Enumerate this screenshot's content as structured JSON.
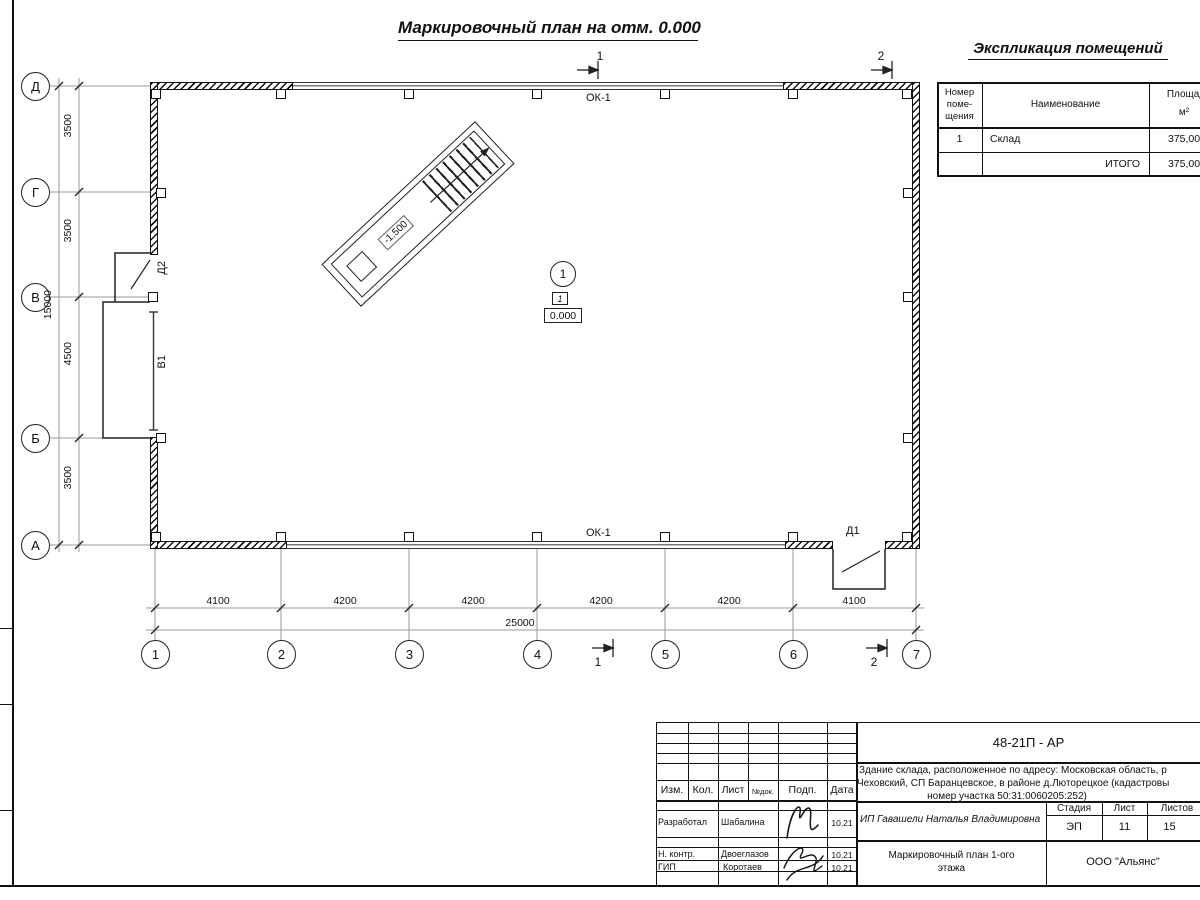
{
  "sheet": {
    "plan_title": "Маркировочный план на отм. 0.000"
  },
  "explication": {
    "title": "Экспликация помещений",
    "col_number_l1": "Номер",
    "col_number_l2": "поме-",
    "col_number_l3": "щения",
    "col_name": "Наименование",
    "col_area_l1": "Площадь,",
    "col_area_l2": "м²",
    "row1_number": "1",
    "row1_name": "Склад",
    "row1_area": "375,00",
    "total_label": "ИТОГО",
    "total_value": "375,00"
  },
  "plan": {
    "ok1_top": "ОК-1",
    "ok1_bottom": "ОК-1",
    "d1": "Д1",
    "d2": "Д2",
    "v1": "В1",
    "ramp_elev": "-1.500",
    "room_circle": "1",
    "room_floor": "1",
    "room_elev": "0.000",
    "sec1_top": "1",
    "sec2_top": "2",
    "sec1_bottom": "1",
    "sec2_bottom": "2",
    "axis_d": "Д",
    "axis_g": "Г",
    "axis_v": "В",
    "axis_b": "Б",
    "axis_a": "А",
    "ax1": "1",
    "ax2": "2",
    "ax3": "3",
    "ax4": "4",
    "ax5": "5",
    "ax6": "6",
    "ax7": "7",
    "dim_dg": "3500",
    "dim_gv": "3500",
    "dim_vb": "4500",
    "dim_ba": "3500",
    "dim_left_total": "15000",
    "dim12": "4100",
    "dim23": "4200",
    "dim34": "4200",
    "dim45": "4200",
    "dim56": "4200",
    "dim67": "4100",
    "dim_bottom_total": "25000"
  },
  "stamp": {
    "doc": "48-21П - АР",
    "desc1": "Здание склада, расположенное по адресу: Московская область, р",
    "desc2": "Чеховский, СП Баранцевское, в районе д.Люторецкое  (кадастровы",
    "desc3": "номер участка 50:31:0060205:252)",
    "h_izm": "Изм.",
    "h_kol": "Кол.",
    "h_list": "Лист",
    "h_ndok": "№док.",
    "h_podp": "Подп.",
    "h_data": "Дата",
    "r1_role": "Разработал",
    "r1_name": "Шабалина",
    "r1_date": "10.21",
    "r2_role": "Н. контр.",
    "r2_name": "Двоеглазов",
    "r2_date": "10.21",
    "r3_role": "ГИП",
    "r3_name": "Коротаев",
    "r3_date": "10.21",
    "client": "ИП Гавашели Наталья Владимировна",
    "stage_h": "Стадия",
    "list_h": "Лист",
    "listov_h": "Листов",
    "stage": "ЭП",
    "list": "11",
    "listov": "15",
    "title1": "Маркировочный план 1-ого",
    "title2": "этажа",
    "company": "ООО \"Альянс\""
  }
}
